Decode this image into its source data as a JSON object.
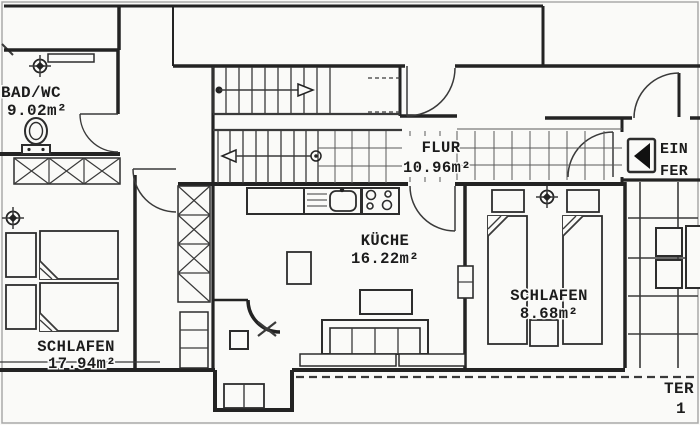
{
  "plan": {
    "type": "apartment-floor-plan",
    "rooms": [
      {
        "id": "bad_wc",
        "name": "BAD/WC",
        "area": "9.02m²"
      },
      {
        "id": "flur",
        "name": "FLUR",
        "area": "10.96m²"
      },
      {
        "id": "kueche",
        "name": "KÜCHE",
        "area": "16.22m²"
      },
      {
        "id": "schlafen_klein",
        "name": "SCHLAFEN",
        "area": "8.68m²"
      },
      {
        "id": "schlafen_gross",
        "name": "SCHLAFEN",
        "area": "17.94m²"
      }
    ],
    "partial_labels": {
      "entrance_line1": "EIN",
      "entrance_line2": "FER",
      "terrace_line1": "TER",
      "terrace_line2": "1"
    },
    "icons": {
      "door_direction_icon": "left-pointing solid triangle in rounded box",
      "lamp_icon": "crosshair ceiling-lamp symbol",
      "toilet_icon": "wc bowl with cistern",
      "stair_up_arrow": "right",
      "stair_down_arrow": "left"
    },
    "colors": {
      "wall": "#232323",
      "line": "#3a3a3a",
      "background": "#fafaf8",
      "scan_border": "#a9a9a9"
    }
  }
}
